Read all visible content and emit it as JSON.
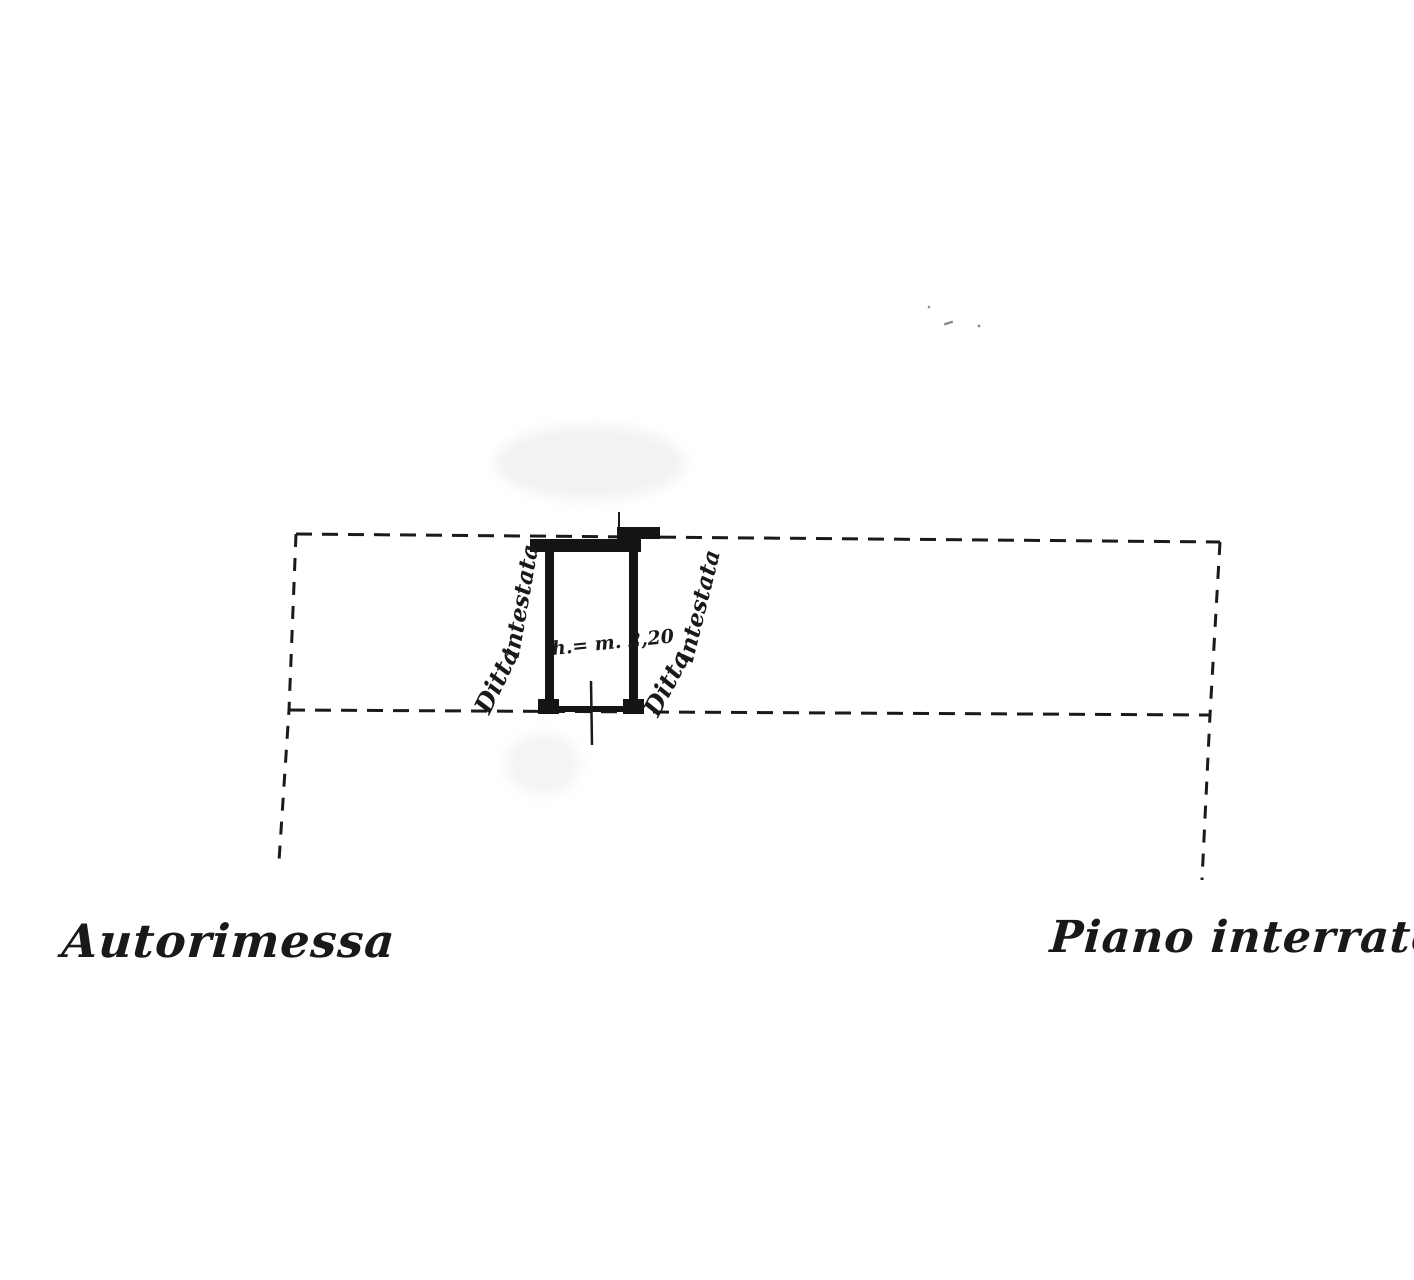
{
  "page": {
    "paper_color": "#ffffff",
    "ink_color": "#191919",
    "speck_color": "#8a8a8a"
  },
  "plan": {
    "garage_unit": {
      "height_label": "h.= m. 2,20",
      "left_owner_label": {
        "word1": "Ditta",
        "word2": "intestata"
      },
      "right_owner_label": {
        "word1": "Ditta",
        "word2": "intestata"
      }
    },
    "captions": {
      "bottom_left": "Autorimessa",
      "bottom_right": "Piano interrato"
    }
  }
}
